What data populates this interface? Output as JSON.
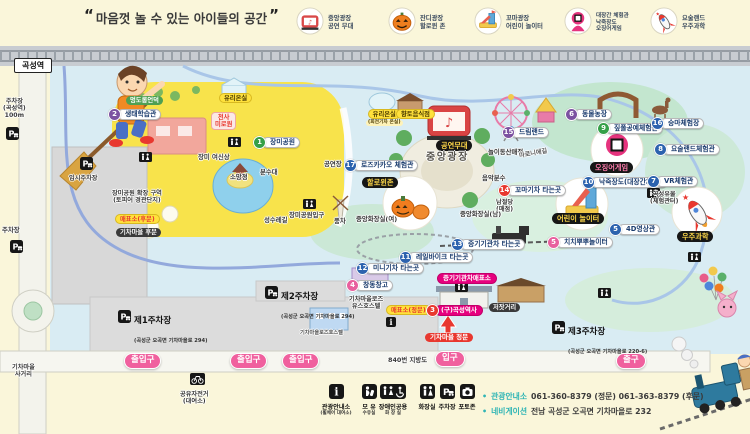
{
  "header": {
    "quote_open": "“",
    "quote": "마음껏 놀 수 있는 아이들의 공간",
    "quote_close": "”",
    "legend": [
      {
        "icon": "stage-icon",
        "lines": "중앙광장\n공연 무대"
      },
      {
        "icon": "pumpkin-icon",
        "lines": "잔디광장\n할로윈 존"
      },
      {
        "icon": "playground-icon",
        "lines": "꼬마광장\n어린이 놀이터"
      },
      {
        "icon": "squid-game-icon",
        "lines": "대장간 체험관\n낙죽장도\n오징어게임"
      },
      {
        "icon": "rocket-icon",
        "lines": "요술랜드\n우주과학"
      }
    ]
  },
  "map": {
    "station_label": "곡성역",
    "colors": {
      "accent_pink": "#F0609E",
      "magenta": "#E6007E",
      "badge_blue": "#2C62AE",
      "badge_green": "#35A048",
      "badge_purple": "#7C51A1",
      "badge_red": "#E8382F",
      "park_yellow": "#F8E34B"
    },
    "items": [
      {
        "n": "1",
        "b": "green",
        "t": "장미공원",
        "x": 253,
        "y": 136,
        "s": "pill"
      },
      {
        "n": "2",
        "b": "purple",
        "t": "생태학습관",
        "x": 108,
        "y": 108,
        "s": "pill"
      },
      {
        "t": "멍도롱언덕",
        "x": 126,
        "y": 96,
        "s": "greenpill"
      },
      {
        "t": "유리온실",
        "x": 219,
        "y": 93,
        "s": "yellow"
      },
      {
        "t": "천사\n미로원",
        "x": 211,
        "y": 112,
        "s": "pinkbox"
      },
      {
        "t": "장미 여신상",
        "x": 198,
        "y": 154,
        "s": "plain"
      },
      {
        "t": "소망정",
        "x": 230,
        "y": 174,
        "s": "plain"
      },
      {
        "t": "분수대",
        "x": 260,
        "y": 169,
        "s": "plain"
      },
      {
        "t": "공연장",
        "x": 324,
        "y": 161,
        "s": "plain"
      },
      {
        "n": "17",
        "b": "blue",
        "t": "로즈카카오 체험관",
        "x": 344,
        "y": 159,
        "s": "pill"
      },
      {
        "t": "할로윈존",
        "x": 362,
        "y": 177,
        "s": "black"
      },
      {
        "t": "유리온실",
        "sub": "(회전기차 온실)",
        "x": 366,
        "y": 109,
        "s": "yellow"
      },
      {
        "t": "향토음식점",
        "x": 396,
        "y": 109,
        "s": "yellow"
      },
      {
        "t": "공연무대",
        "x": 436,
        "y": 140,
        "s": "black"
      },
      {
        "t": "중앙광장",
        "x": 426,
        "y": 152,
        "s": "plainbig"
      },
      {
        "n": "15",
        "b": "purple",
        "t": "드림랜드",
        "x": 502,
        "y": 126,
        "s": "pill"
      },
      {
        "t": "놀이동산매점",
        "x": 488,
        "y": 149,
        "s": "plain"
      },
      {
        "n": "6",
        "b": "purple",
        "t": "동물농장",
        "x": 565,
        "y": 108,
        "s": "pill"
      },
      {
        "n": "9",
        "b": "green",
        "t": "짚풀공예체험관",
        "x": 597,
        "y": 122,
        "s": "pill"
      },
      {
        "n": "16",
        "b": "blue",
        "t": "승마체험장",
        "x": 651,
        "y": 117,
        "s": "pill"
      },
      {
        "n": "8",
        "b": "blue",
        "t": "요술랜드체험관",
        "x": 654,
        "y": 143,
        "s": "pill"
      },
      {
        "t": "오징어게임",
        "x": 590,
        "y": 162,
        "s": "blackpink"
      },
      {
        "n": "10",
        "b": "blue",
        "t": "낙죽장도(대장간체험)",
        "x": 582,
        "y": 176,
        "s": "pill"
      },
      {
        "n": "7",
        "b": "blue",
        "t": "VR체험관",
        "x": 647,
        "y": 175,
        "s": "pill"
      },
      {
        "t": "곡성유물\n(체험관터)",
        "x": 650,
        "y": 191,
        "s": "plain2"
      },
      {
        "t": "마로니에길",
        "x": 519,
        "y": 150,
        "s": "plainrot"
      },
      {
        "t": "음악분수",
        "x": 482,
        "y": 175,
        "s": "plain"
      },
      {
        "n": "14",
        "b": "red",
        "t": "꼬마기차 타는곳",
        "x": 498,
        "y": 184,
        "s": "pill"
      },
      {
        "t": "남절당\n(매점)",
        "x": 496,
        "y": 199,
        "s": "plain2"
      },
      {
        "t": "중앙화장실(여)",
        "x": 356,
        "y": 216,
        "s": "plain"
      },
      {
        "t": "중앙화장실(남)",
        "x": 460,
        "y": 211,
        "s": "plain"
      },
      {
        "t": "풍차",
        "x": 334,
        "y": 218,
        "s": "plain"
      },
      {
        "t": "성수레길",
        "x": 264,
        "y": 217,
        "s": "plain"
      },
      {
        "t": "장미공원입구",
        "x": 289,
        "y": 212,
        "s": "plain"
      },
      {
        "t": "어린이 놀이터",
        "x": 552,
        "y": 213,
        "s": "black"
      },
      {
        "n": "5",
        "b": "pink",
        "t": "치치뿌뿌놀이터",
        "x": 547,
        "y": 236,
        "s": "pill"
      },
      {
        "n": "5",
        "b": "blue",
        "t": "4D영상관",
        "x": 609,
        "y": 223,
        "s": "pill"
      },
      {
        "t": "우주과학",
        "x": 677,
        "y": 231,
        "s": "black"
      },
      {
        "n": "13",
        "b": "blue",
        "t": "증기기관차 타는곳",
        "x": 451,
        "y": 238,
        "s": "pill"
      },
      {
        "n": "11",
        "b": "blue",
        "t": "레일바이크 타는곳",
        "x": 399,
        "y": 251,
        "s": "pill"
      },
      {
        "n": "12",
        "b": "blue",
        "t": "미니기차 타는곳",
        "x": 356,
        "y": 262,
        "s": "pill"
      },
      {
        "t": "증기기관차매표소",
        "x": 437,
        "y": 273,
        "s": "magenta"
      },
      {
        "n": "4",
        "b": "pink",
        "t": "창동창고",
        "x": 346,
        "y": 279,
        "s": "pill"
      },
      {
        "t": "기차마을로즈\n유스호스텔",
        "x": 349,
        "y": 296,
        "s": "plain2"
      },
      {
        "t": "기차마을로즈호스텔",
        "x": 300,
        "y": 331,
        "s": "tiny"
      },
      {
        "t": "매표소(정문)",
        "x": 386,
        "y": 305,
        "s": "yellowred"
      },
      {
        "n": "3",
        "b": "red",
        "t": "(구)곡성역사",
        "x": 426,
        "y": 304,
        "s": "magenta"
      },
      {
        "t": "저잣거리",
        "x": 489,
        "y": 303,
        "s": "darkpill"
      },
      {
        "t": "기차마을 정문",
        "x": 425,
        "y": 333,
        "s": "redpill"
      },
      {
        "t": "입구",
        "x": 435,
        "y": 351,
        "s": "gate"
      },
      {
        "t": "출구",
        "x": 616,
        "y": 353,
        "s": "gate"
      },
      {
        "t": "출입구",
        "x": 124,
        "y": 353,
        "s": "gate"
      },
      {
        "t": "출입구",
        "x": 230,
        "y": 353,
        "s": "gate"
      },
      {
        "t": "출입구",
        "x": 282,
        "y": 353,
        "s": "gate"
      },
      {
        "t": "840번 지방도",
        "x": 388,
        "y": 357,
        "s": "plain"
      },
      {
        "t": "임시주차장",
        "x": 69,
        "y": 175,
        "s": "plain2"
      },
      {
        "t": "장미공원 확장 구역\n(토피어 경관단지)",
        "x": 112,
        "y": 190,
        "s": "plain2"
      },
      {
        "t": "기차마을\n사거리",
        "x": 12,
        "y": 364,
        "s": "plain2"
      },
      {
        "t": "공유자전거\n(대여소)",
        "x": 180,
        "y": 391,
        "s": "plain2"
      },
      {
        "t": "주차장\n(곡성역)\n100m",
        "x": 3,
        "y": 98,
        "s": "plain2"
      },
      {
        "t": "주차장",
        "x": 2,
        "y": 227,
        "s": "plain"
      },
      {
        "t": "매표소(후문)",
        "x": 115,
        "y": 214,
        "s": "yellowred"
      },
      {
        "t": "기차마을 후문",
        "x": 116,
        "y": 228,
        "s": "darkpill"
      }
    ],
    "parkings": [
      {
        "t": "제1주차장",
        "sub": "(곡성군 오곡면 기차마을로 294)",
        "x": 118,
        "y": 308
      },
      {
        "t": "제2주차장",
        "sub": "(곡성군 오곡면 기차마을로 294)",
        "x": 265,
        "y": 284
      },
      {
        "t": "제3주차장",
        "sub": "(곡성군 오곡면 기차마을로 220-6)",
        "x": 552,
        "y": 319
      }
    ],
    "p_icons": [
      [
        6,
        127
      ],
      [
        10,
        240
      ],
      [
        80,
        157
      ]
    ],
    "facility_icons": [
      [
        139,
        152
      ],
      [
        228,
        137
      ],
      [
        303,
        199
      ],
      [
        455,
        282
      ],
      [
        598,
        288
      ],
      [
        647,
        188
      ],
      [
        688,
        252
      ]
    ],
    "info_icon": [
      386,
      317
    ],
    "bike_icon": [
      190,
      373
    ]
  },
  "footer": {
    "legend": [
      {
        "icon": "info-icon",
        "label": "관광안내소",
        "sub": "(휠체어 대여소)"
      },
      {
        "icon": "nursing-icon",
        "label": "모 유",
        "sub": "수유실"
      },
      {
        "icon": "accessible-restroom-icon",
        "label": "장애인공용",
        "sub": "화 장 실"
      },
      {
        "icon": "restroom-icon",
        "label": "화장실",
        "sub": ""
      },
      {
        "icon": "parking-icon",
        "label": "주차장",
        "sub": ""
      },
      {
        "icon": "photozone-icon",
        "label": "포토존",
        "sub": ""
      }
    ],
    "info": [
      {
        "label": "관광안내소",
        "text": "061-360-8379 (정문) 061-363-8379 (후문)"
      },
      {
        "label": "네비게이션",
        "text": "전남 곡성군 오곡면 기차마을로 232"
      }
    ]
  }
}
